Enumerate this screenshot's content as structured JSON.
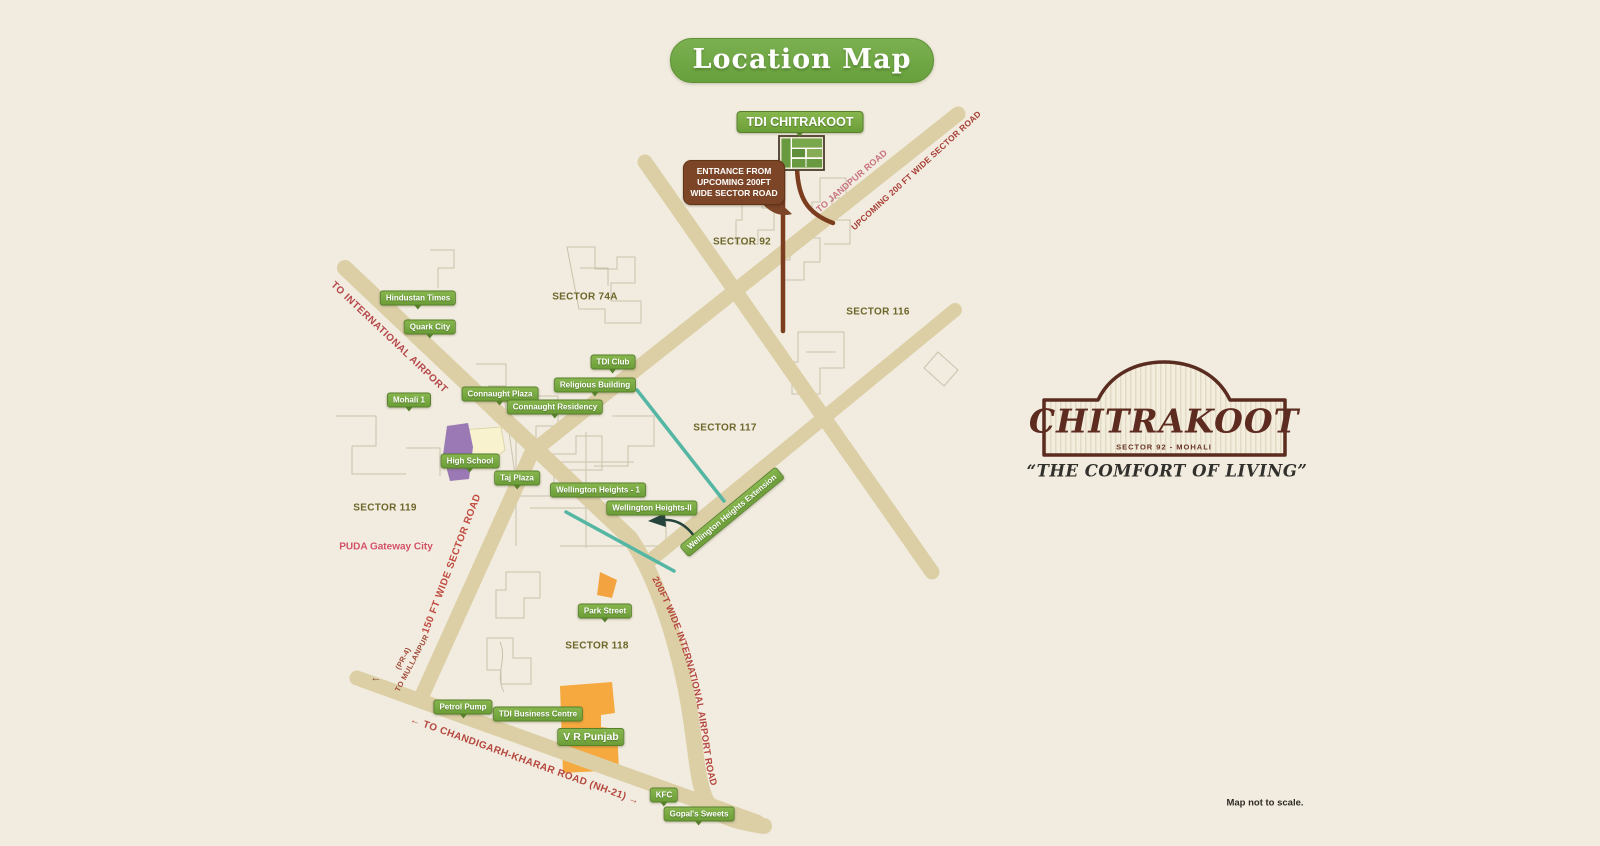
{
  "header": {
    "title": "Location Map"
  },
  "project": {
    "label": "TDI CHITRAKOOT"
  },
  "entrance_callout": {
    "lines": [
      "ENTRANCE FROM",
      "UPCOMING 200FT",
      "WIDE SECTOR ROAD"
    ]
  },
  "branding": {
    "name": "CHITRAKOOT",
    "subtitle": "SECTOR 92 - MOHALI",
    "tagline": "“THE COMFORT OF LIVING”"
  },
  "footnote": "Map not to scale.",
  "colors": {
    "background": "#f1ecdf",
    "road_tan": "#dccfa6",
    "label_green": "#76a83c",
    "road_text_red": "#b5464a",
    "brand_brown": "#5d2b20",
    "entrance_road_brown": "#7c3c1e",
    "teal_line": "#54b6a3",
    "orange_building": "#f5a93f",
    "purple_building": "#9a79b5"
  },
  "map": {
    "sectors": [
      {
        "text": "SECTOR 92",
        "x": 742,
        "y": 242
      },
      {
        "text": "SECTOR 74A",
        "x": 585,
        "y": 297
      },
      {
        "text": "SECTOR 116",
        "x": 878,
        "y": 312
      },
      {
        "text": "SECTOR 117",
        "x": 725,
        "y": 428
      },
      {
        "text": "SECTOR 119",
        "x": 385,
        "y": 508
      },
      {
        "text": "SECTOR 118",
        "x": 597,
        "y": 646
      }
    ],
    "places": [
      {
        "text": "Hindustan Times",
        "x": 418,
        "y": 298,
        "pointer": true
      },
      {
        "text": "Quark City",
        "x": 430,
        "y": 327,
        "pointer": true
      },
      {
        "text": "Mohali 1",
        "x": 409,
        "y": 400,
        "pointer": true
      },
      {
        "text": "Connaught Plaza",
        "x": 500,
        "y": 394,
        "pointer": true
      },
      {
        "text": "Connaught Residency",
        "x": 555,
        "y": 407,
        "pointer": true
      },
      {
        "text": "TDI Club",
        "x": 613,
        "y": 362,
        "pointer": true
      },
      {
        "text": "Religious Building",
        "x": 595,
        "y": 385,
        "pointer": true
      },
      {
        "text": "High School",
        "x": 470,
        "y": 461,
        "pointer": true
      },
      {
        "text": "Taj Plaza",
        "x": 517,
        "y": 478,
        "pointer": true
      },
      {
        "text": "Wellington Heights - 1",
        "x": 598,
        "y": 490,
        "pointer": false
      },
      {
        "text": "Wellington Heights-II",
        "x": 652,
        "y": 508,
        "pointer": false
      },
      {
        "text": "Wellington Heights Extension",
        "x": 732,
        "y": 512,
        "pointer": false,
        "rot": -39.5
      },
      {
        "text": "Park Street",
        "x": 605,
        "y": 611,
        "pointer": true
      },
      {
        "text": "Petrol Pump",
        "x": 463,
        "y": 707,
        "pointer": true
      },
      {
        "text": "TDI Business Centre",
        "x": 538,
        "y": 714,
        "pointer": false
      },
      {
        "text": "V R Punjab",
        "x": 591,
        "y": 737,
        "pointer": false,
        "size": 10.5
      },
      {
        "text": "KFC",
        "x": 664,
        "y": 795,
        "pointer": true
      },
      {
        "text": "Gopal's Sweets",
        "x": 699,
        "y": 814,
        "pointer": true
      }
    ],
    "road_labels": [
      {
        "text": "TO INTERNATIONAL AIRPORT"
      },
      {
        "text": "150 FT WIDE SECTOR ROAD"
      },
      {
        "text": "UPCOMING 200 FT WIDE SECTOR ROAD"
      },
      {
        "text": "TO JANDPUR ROAD →"
      },
      {
        "text": "200FT WIDE INTERNATIONAL AIRPORT ROAD"
      },
      {
        "text": "← TO CHANDIGARH-KHARAR ROAD (NH-21) →"
      }
    ],
    "puda": "PUDA Gateway City",
    "mullanpur": [
      "(PR-4)",
      "TO MULLANPUR"
    ],
    "start_arrow": "←"
  }
}
